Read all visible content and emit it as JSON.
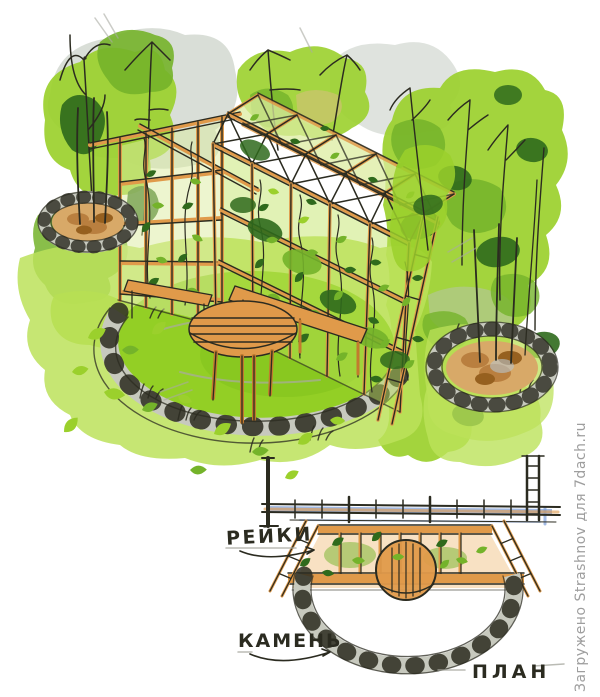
{
  "illustration": {
    "description": "Watercolor garden sketch: wooden trellis pergola with climbing plants, bench, round table on a stone-edged lawn circle, two round stone planting beds, and a plan drawing below",
    "labels": {
      "slats": "РЕЙКИ",
      "stone": "КАМЕНЬ",
      "plan": "ПЛАН"
    },
    "watermark": "Загружено Strashnov для 7dach.ru",
    "colors": {
      "paper": "#ffffff",
      "ink": "#2b2b20",
      "pencil": "#a9aaa1",
      "wash_gray": "#b9c2b6",
      "bright_green": "#9bd02c",
      "light_green": "#bce25a",
      "pale_green": "#dcecA0",
      "mid_green": "#74b32a",
      "dark_green": "#2f6a1c",
      "lawn_green": "#93cf25",
      "lawn_shadow": "#7fbf1b",
      "tan_wash": "#d6c07a",
      "wood": "#e09a4a",
      "wood_dark": "#c27a2e",
      "wood_light": "#f2c488",
      "mulch": "#b97f3f",
      "mulch_dark": "#96601f",
      "mulch_light": "#d8a968",
      "stone_gray": "#c7c9be",
      "blue_accent": "#7b9cd8",
      "watermark_gray": "#9e9e9e"
    }
  }
}
